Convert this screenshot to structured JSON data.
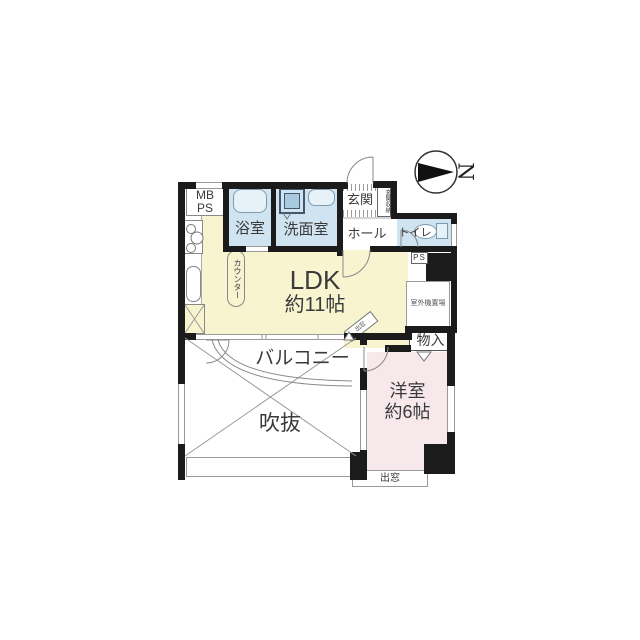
{
  "compass": {
    "north": "N"
  },
  "rooms": {
    "mb_ps": {
      "line1": "MB",
      "line2": "PS"
    },
    "bath": {
      "label": "浴室"
    },
    "washroom": {
      "label": "洗面室"
    },
    "entrance": {
      "label": "玄関"
    },
    "entrance_storage": {
      "label": "玄関収納"
    },
    "hall": {
      "label": "ホール"
    },
    "toilet": {
      "label": "トイレ"
    },
    "pipe_space": {
      "label": "PS"
    },
    "outdoor_unit_space": {
      "label": "室外機置場"
    },
    "ldk": {
      "label": "LDK",
      "size": "約11帖"
    },
    "kitchen_counter": {
      "label": "カウンター"
    },
    "balcony": {
      "label": "バルコニー"
    },
    "void_space": {
      "label": "吹抜"
    },
    "western_room": {
      "label": "洋室",
      "size": "約6帖"
    },
    "closet": {
      "label": "物入"
    },
    "bay_window": {
      "label": "出窓"
    },
    "corner_bay_window": {
      "label": "出窓"
    }
  },
  "colors": {
    "wall": "#1b1b1b",
    "wet_area": "#cfe4f0",
    "living": "#f8f4d0",
    "bedroom": "#f7e8ec",
    "outline": "#888888"
  }
}
